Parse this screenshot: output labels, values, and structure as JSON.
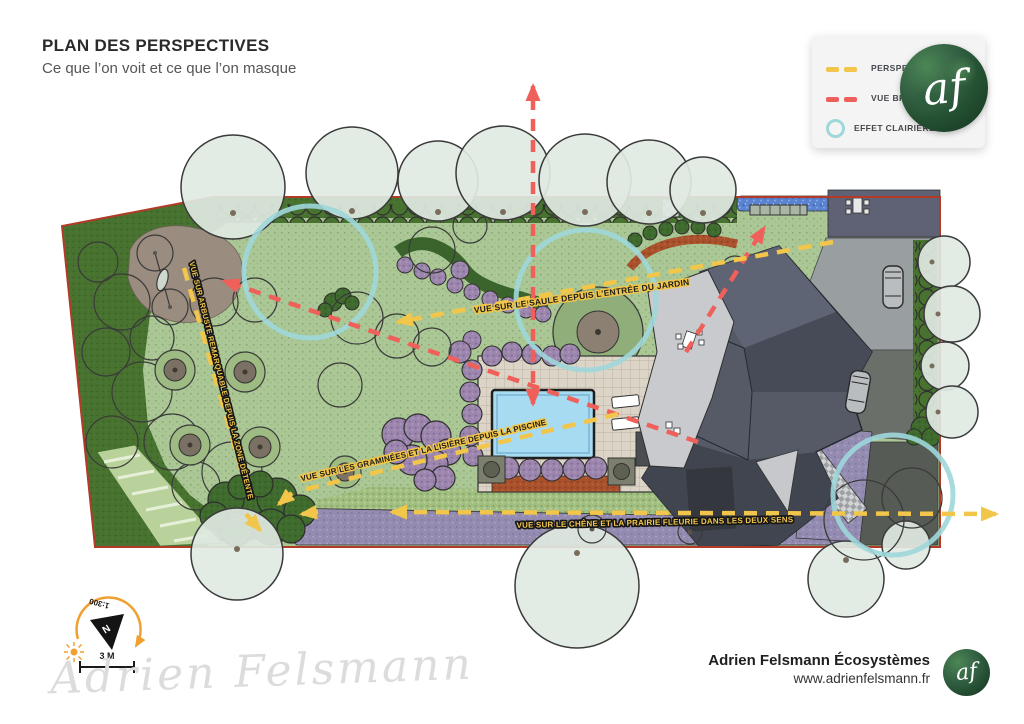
{
  "header": {
    "title": "PLAN DES PERSPECTIVES",
    "subtitle": "Ce que l’on voit et ce que l’on masque"
  },
  "legend": {
    "items": [
      {
        "id": "perspective",
        "label": "PERSPECTIVE",
        "symbol": "yellow-dashed-line",
        "color": "#F2C64A"
      },
      {
        "id": "vue-brisee",
        "label": "VUE BRISÉE",
        "symbol": "red-dashed-line",
        "color": "#F0605A"
      },
      {
        "id": "effet-clairiere",
        "label": "EFFET CLAIRIÈRE",
        "symbol": "teal-circle-outline",
        "color": "#9FD7DA"
      }
    ]
  },
  "plan": {
    "labels": {
      "saule": "VUE SUR LE SAULE DEPUIS L’ENTRÉE DU JARDIN",
      "graminees": "VUE SUR LES GRAMINÉES ET LA LISIÈRE DEPUIS LA PISCINE",
      "chene": "VUE SUR LE CHÊNE ET LA PRAIRIE FLEURIE DANS LES DEUX SENS",
      "arbuste": "VUE SUR ARBUSTE REMARQUABLE DEPUIS LA ZONE DÉTENTE"
    },
    "compass": {
      "north": "N",
      "scale_ratio": "1:300"
    },
    "scale_bar": {
      "label": "3 M"
    }
  },
  "signature": "Adrien Felsmann",
  "brand": {
    "monogram": "af"
  },
  "footer": {
    "company": "Adrien Felsmann Écosystèmes",
    "website": "www.adrienfelsmann.fr"
  },
  "colors": {
    "perspective_line": "#F2C64A",
    "vue_brisee_line": "#F0605A",
    "effet_clairiere": "#9FD7DA",
    "lawn": "#ABC795",
    "woodland": "#48722F",
    "pool": "#A6DBF2"
  }
}
